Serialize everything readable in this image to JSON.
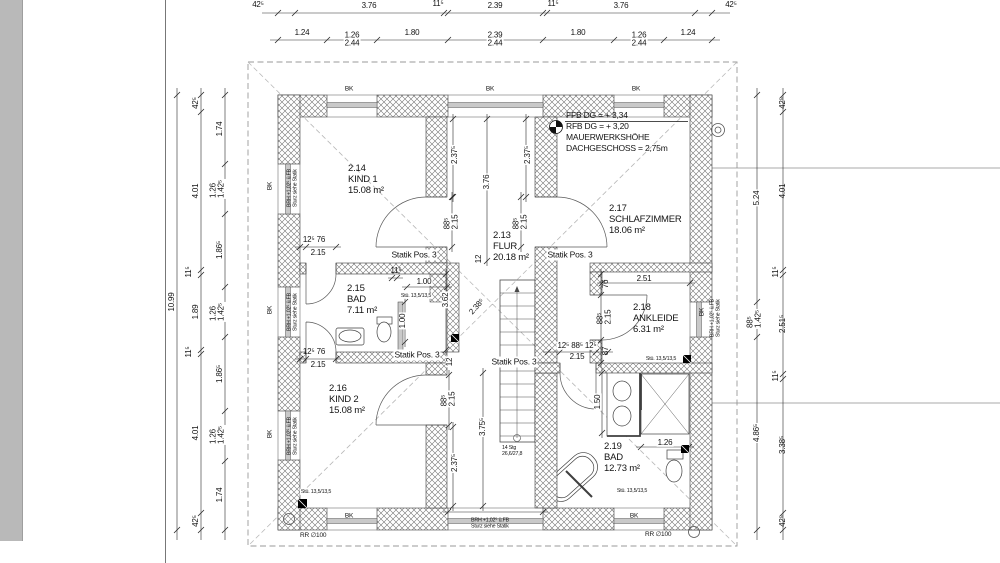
{
  "colors": {
    "paper": "#ffffff",
    "panel": "#b9b9b9",
    "hatch": "#707070",
    "line": "#2b2b2b"
  },
  "plan": {
    "rooms": [
      {
        "id": "2.14",
        "name": "KIND 1",
        "area": "15.08 m²",
        "x": 348,
        "y": 163
      },
      {
        "id": "2.13",
        "name": "FLUR",
        "area": "20.18 m²",
        "x": 493,
        "y": 230
      },
      {
        "id": "2.17",
        "name": "SCHLAFZIMMER",
        "area": "18.06 m²",
        "x": 609,
        "y": 203
      },
      {
        "id": "2.15",
        "name": "BAD",
        "area": "7.11 m²",
        "x": 347,
        "y": 283
      },
      {
        "id": "2.18",
        "name": "ANKLEIDE",
        "area": "6.31 m²",
        "x": 633,
        "y": 302
      },
      {
        "id": "2.16",
        "name": "KIND 2",
        "area": "15.08 m²",
        "x": 329,
        "y": 383
      },
      {
        "id": "2.19",
        "name": "BAD",
        "area": "12.73 m²",
        "x": 604,
        "y": 441
      }
    ],
    "level_block": {
      "x": 566,
      "y": 110,
      "lines": [
        "FFB DG = + 3,34",
        "RFB DG = + 3,20",
        "MAUERWERKSHÖHE",
        "DACHGESCHOSS = 2,75m"
      ]
    },
    "statik_label": {
      "text": "Statik Pos. 3",
      "positions": [
        {
          "x": 414,
          "y": 255
        },
        {
          "x": 570,
          "y": 255
        },
        {
          "x": 417,
          "y": 355
        },
        {
          "x": 514,
          "y": 362
        }
      ]
    },
    "stair_note": {
      "x": 502,
      "y": 445,
      "lines": [
        "14 Stg",
        "26,6/27,8"
      ]
    },
    "window_mark": {
      "text": "BK",
      "positions": [
        {
          "x": 349,
          "y": 90
        },
        {
          "x": 490,
          "y": 90
        },
        {
          "x": 636,
          "y": 90
        },
        {
          "x": 349,
          "y": 517
        },
        {
          "x": 634,
          "y": 517
        },
        {
          "x": 271,
          "y": 186,
          "r": -90
        },
        {
          "x": 271,
          "y": 310,
          "r": -90
        },
        {
          "x": 271,
          "y": 434,
          "r": -90
        },
        {
          "x": 703,
          "y": 312,
          "r": -90
        }
      ]
    },
    "lintel_note": {
      "text": "BRH +1,02⁵ ü.FB\nSturz siehe Statik",
      "positions": [
        {
          "x": 490,
          "y": 524
        },
        {
          "x": 293,
          "y": 188,
          "r": -90
        },
        {
          "x": 293,
          "y": 312,
          "r": -90
        },
        {
          "x": 293,
          "y": 436,
          "r": -90
        },
        {
          "x": 716,
          "y": 318,
          "r": -90
        }
      ]
    },
    "column_note": {
      "text": "Stü. 13,5/13,5",
      "positions": [
        {
          "x": 416,
          "y": 296
        },
        {
          "x": 316,
          "y": 492
        },
        {
          "x": 661,
          "y": 359
        },
        {
          "x": 632,
          "y": 491
        }
      ]
    },
    "pipe_label": {
      "text": "RR ∅100",
      "positions": [
        {
          "x": 300,
          "y": 533
        },
        {
          "x": 645,
          "y": 532
        }
      ]
    },
    "dims": [
      {
        "t": "42⁵",
        "x": 258,
        "y": 5
      },
      {
        "t": "3.76",
        "x": 369,
        "y": 6
      },
      {
        "t": "11⁵",
        "x": 438,
        "y": 4
      },
      {
        "t": "2.39",
        "x": 495,
        "y": 6
      },
      {
        "t": "11⁵",
        "x": 553,
        "y": 4
      },
      {
        "t": "3.76",
        "x": 621,
        "y": 6
      },
      {
        "t": "42⁵",
        "x": 731,
        "y": 5
      },
      {
        "t": "1.24",
        "x": 302,
        "y": 33
      },
      {
        "t": "1.26\n2.44",
        "x": 352,
        "y": 40,
        "ml": 1,
        "bg": 1
      },
      {
        "t": "1.80",
        "x": 412,
        "y": 33
      },
      {
        "t": "2.39\n2.44",
        "x": 495,
        "y": 40,
        "ml": 1,
        "bg": 1
      },
      {
        "t": "1.80",
        "x": 578,
        "y": 33
      },
      {
        "t": "1.26\n2.44",
        "x": 639,
        "y": 40,
        "ml": 1,
        "bg": 1
      },
      {
        "t": "1.24",
        "x": 688,
        "y": 33
      },
      {
        "t": "10.99",
        "x": 172,
        "y": 302,
        "r": -90
      },
      {
        "t": "42⁵",
        "x": 196,
        "y": 103,
        "r": -90
      },
      {
        "t": "4.01",
        "x": 196,
        "y": 191,
        "r": -90
      },
      {
        "t": "11⁵",
        "x": 189,
        "y": 272,
        "r": -90
      },
      {
        "t": "1.89",
        "x": 196,
        "y": 312,
        "r": -90
      },
      {
        "t": "11⁵",
        "x": 189,
        "y": 352,
        "r": -90
      },
      {
        "t": "4.01",
        "x": 196,
        "y": 433,
        "r": -90
      },
      {
        "t": "42⁵",
        "x": 196,
        "y": 521,
        "r": -90
      },
      {
        "t": "1.74",
        "x": 220,
        "y": 129,
        "r": -90
      },
      {
        "t": "1.26\n1.42⁵",
        "x": 218,
        "y": 189,
        "r": -90,
        "ml": 1,
        "bg": 1
      },
      {
        "t": "1.86⁵",
        "x": 220,
        "y": 250,
        "r": -90
      },
      {
        "t": "1.26\n1.42⁵",
        "x": 218,
        "y": 312,
        "r": -90,
        "ml": 1,
        "bg": 1
      },
      {
        "t": "1.86⁵",
        "x": 220,
        "y": 374,
        "r": -90
      },
      {
        "t": "1.26\n1.42⁵",
        "x": 218,
        "y": 435,
        "r": -90,
        "ml": 1,
        "bg": 1
      },
      {
        "t": "1.74",
        "x": 220,
        "y": 495,
        "r": -90
      },
      {
        "t": "5.24",
        "x": 757,
        "y": 198,
        "r": -90,
        "bg": 1
      },
      {
        "t": "88⁵\n1.42⁵",
        "x": 755,
        "y": 319,
        "r": -90,
        "ml": 1,
        "bg": 1
      },
      {
        "t": "4.86⁵",
        "x": 757,
        "y": 433,
        "r": -90,
        "bg": 1
      },
      {
        "t": "42⁵",
        "x": 783,
        "y": 103,
        "r": -90
      },
      {
        "t": "4.01",
        "x": 783,
        "y": 191,
        "r": -90
      },
      {
        "t": "11⁵",
        "x": 776,
        "y": 272,
        "r": -90
      },
      {
        "t": "2.51⁵",
        "x": 783,
        "y": 324,
        "r": -90
      },
      {
        "t": "11⁵",
        "x": 776,
        "y": 376,
        "r": -90
      },
      {
        "t": "3.38⁵",
        "x": 783,
        "y": 445,
        "r": -90
      },
      {
        "t": "42⁵",
        "x": 783,
        "y": 521,
        "r": -90
      },
      {
        "t": "88⁵\n2.15",
        "x": 452,
        "y": 222,
        "r": -90,
        "ml": 1,
        "bg": 1
      },
      {
        "t": "2.37⁵",
        "x": 455,
        "y": 155,
        "r": -90,
        "bg": 1
      },
      {
        "t": "3.76",
        "x": 487,
        "y": 182,
        "r": -90,
        "bg": 1
      },
      {
        "t": "88⁵\n2.15",
        "x": 521,
        "y": 222,
        "r": -90,
        "ml": 1,
        "bg": 1
      },
      {
        "t": "2.37⁵",
        "x": 528,
        "y": 155,
        "r": -90,
        "bg": 1
      },
      {
        "t": "3.62",
        "x": 446,
        "y": 300,
        "r": -90,
        "bg": 1
      },
      {
        "t": "2.38⁵",
        "x": 477,
        "y": 307,
        "r": -48
      },
      {
        "t": "12",
        "x": 479,
        "y": 259,
        "r": -90
      },
      {
        "t": "12",
        "x": 450,
        "y": 362,
        "r": -90,
        "bg": 1
      },
      {
        "t": "88⁵\n2.15",
        "x": 449,
        "y": 399,
        "r": -90,
        "ml": 1,
        "bg": 1
      },
      {
        "t": "2.37⁵",
        "x": 455,
        "y": 463,
        "r": -90,
        "bg": 1
      },
      {
        "t": "3.75⁵",
        "x": 483,
        "y": 427,
        "r": -90,
        "bg": 1
      },
      {
        "t": "12⁵  76",
        "x": 314,
        "y": 240
      },
      {
        "t": "2.15",
        "x": 318,
        "y": 253
      },
      {
        "t": "12⁵  76",
        "x": 314,
        "y": 352
      },
      {
        "t": "2.15",
        "x": 318,
        "y": 365
      },
      {
        "t": "11⁵",
        "x": 396,
        "y": 271
      },
      {
        "t": "1.00",
        "x": 424,
        "y": 282,
        "bg": 1
      },
      {
        "t": "1.00",
        "x": 403,
        "y": 321,
        "r": -90,
        "bg": 1
      },
      {
        "t": "2.51",
        "x": 644,
        "y": 279
      },
      {
        "t": "76",
        "x": 606,
        "y": 284,
        "r": -90
      },
      {
        "t": "88⁵\n2.15",
        "x": 605,
        "y": 317,
        "r": -90,
        "ml": 1
      },
      {
        "t": "87",
        "x": 606,
        "y": 351,
        "r": -90
      },
      {
        "t": "1.50",
        "x": 598,
        "y": 402,
        "r": -90,
        "bg": 1
      },
      {
        "t": "1.26",
        "x": 665,
        "y": 443,
        "bg": 1
      },
      {
        "t": "12⁵ 88⁵ 12⁵",
        "x": 577,
        "y": 346,
        "bg": 1
      },
      {
        "t": "2.15",
        "x": 577,
        "y": 357,
        "bg": 1
      }
    ]
  }
}
